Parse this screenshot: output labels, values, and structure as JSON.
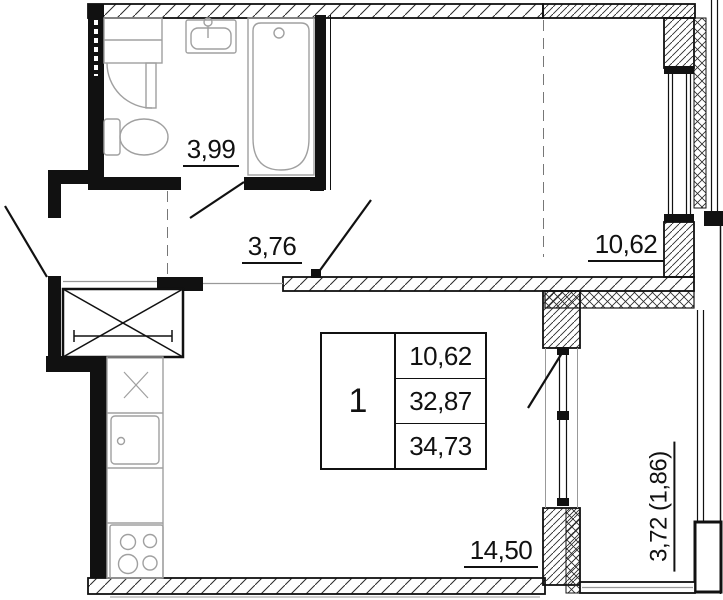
{
  "title": "one-room apartment floor plan",
  "rooms": {
    "bathroom": {
      "area": "3,99"
    },
    "hallway": {
      "area": "3,76"
    },
    "living_room": {
      "area": "10,62"
    },
    "kitchen_living": {
      "area": "14,50"
    },
    "balcony": {
      "area": "3,72 (1,86)"
    }
  },
  "info_table": {
    "rooms_count": "1",
    "living_area": "10,62",
    "apartment_area": "32,87",
    "total_area": "34,73"
  },
  "colors": {
    "line": "#111111",
    "fixture": "#a0a0a0",
    "background": "#ffffff"
  }
}
